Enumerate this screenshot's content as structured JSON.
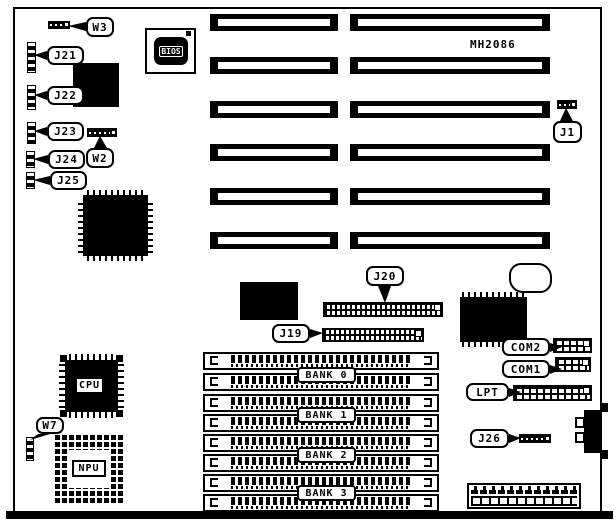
{
  "diagram": {
    "title_chip": "MH2086",
    "callouts": {
      "w3": "W3",
      "j21": "J21",
      "j22": "J22",
      "j23": "J23",
      "j24": "J24",
      "j25": "J25",
      "w2": "W2",
      "j1": "J1",
      "j20": "J20",
      "j19": "J19",
      "com2": "COM2",
      "com1": "COM1",
      "lpt": "LPT",
      "j26": "J26",
      "w7": "W7"
    },
    "chips": {
      "bios": "BIOS",
      "cpu": "CPU",
      "npu": "NPU"
    },
    "banks": [
      "BANK 0",
      "BANK 1",
      "BANK 2",
      "BANK 3"
    ],
    "colors": {
      "line": "#000000",
      "background": "#ffffff"
    }
  }
}
